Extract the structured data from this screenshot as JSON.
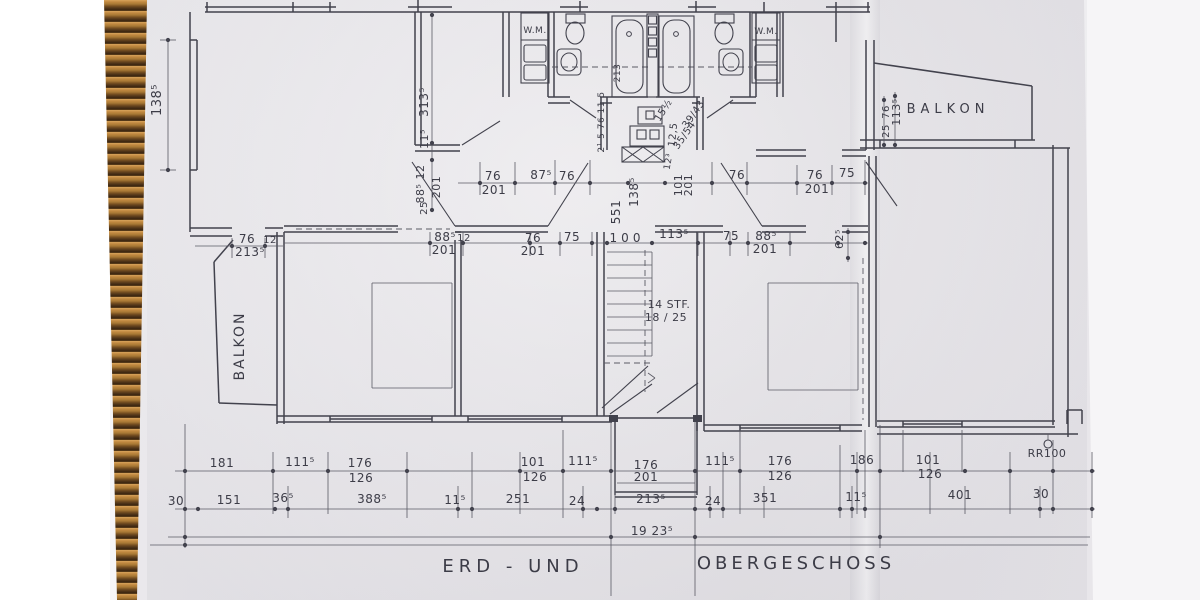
{
  "titles": {
    "left": "ERD - UND",
    "right": "OBERGESCHOSS"
  },
  "colors": {
    "paper": "#e7e5e9",
    "ink": "#42424d",
    "thin_line": "#5a5a64",
    "wicker_light": "#d8a45c",
    "wicker_dark": "#53371a",
    "background": "#ffffff"
  },
  "plan": {
    "labels": [
      {
        "t": "138⁵",
        "x": 161,
        "y": 100,
        "r": -90,
        "s": 13
      },
      {
        "t": "BALKON",
        "x": 244,
        "y": 346,
        "r": -90,
        "s": 14,
        "ls": 2,
        "n": "room-label-balkon-left"
      },
      {
        "t": "76",
        "x": 247,
        "y": 243,
        "s": 12
      },
      {
        "t": "213⁵",
        "x": 250,
        "y": 256,
        "s": 12
      },
      {
        "t": "12",
        "x": 270,
        "y": 243,
        "s": 10
      },
      {
        "t": "313⁵",
        "x": 428,
        "y": 102,
        "r": -90,
        "s": 12
      },
      {
        "t": "11⁵",
        "x": 428,
        "y": 139,
        "r": -90,
        "s": 11
      },
      {
        "t": "88⁵ 12",
        "x": 424,
        "y": 184,
        "r": -90,
        "s": 11
      },
      {
        "t": "201",
        "x": 440,
        "y": 187,
        "r": -90,
        "s": 11
      },
      {
        "t": "25",
        "x": 427,
        "y": 208,
        "r": -90,
        "s": 10
      },
      {
        "t": "W.M.",
        "x": 535,
        "y": 33,
        "s": 9,
        "n": "room-label-wm-left"
      },
      {
        "t": "W.M.",
        "x": 766,
        "y": 34,
        "s": 9,
        "n": "room-label-wm-right"
      },
      {
        "t": "213",
        "x": 620,
        "y": 73,
        "r": -90,
        "s": 9
      },
      {
        "t": "2¹ 5 76 11 5",
        "x": 604,
        "y": 122,
        "r": -90,
        "s": 9
      },
      {
        "t": "15½",
        "x": 666,
        "y": 112,
        "r": -58,
        "s": 10
      },
      {
        "t": "12,5",
        "x": 676,
        "y": 135,
        "r": -84,
        "s": 10
      },
      {
        "t": "35/54",
        "x": 687,
        "y": 137,
        "r": -55,
        "s": 10
      },
      {
        "t": "39/43",
        "x": 696,
        "y": 116,
        "r": -55,
        "s": 10
      },
      {
        "t": "12³",
        "x": 671,
        "y": 162,
        "r": -80,
        "s": 9
      },
      {
        "t": "551",
        "x": 620,
        "y": 212,
        "r": -90,
        "s": 12
      },
      {
        "t": "138⁵",
        "x": 638,
        "y": 192,
        "r": -90,
        "s": 12
      },
      {
        "t": "101",
        "x": 682,
        "y": 185,
        "r": -90,
        "s": 11
      },
      {
        "t": "201",
        "x": 692,
        "y": 185,
        "r": -90,
        "s": 11
      },
      {
        "t": "76",
        "x": 493,
        "y": 180,
        "s": 12
      },
      {
        "t": "201",
        "x": 494,
        "y": 194,
        "s": 12
      },
      {
        "t": "87⁵",
        "x": 541,
        "y": 179,
        "s": 12
      },
      {
        "t": "76",
        "x": 567,
        "y": 180,
        "s": 12
      },
      {
        "t": "76",
        "x": 737,
        "y": 179,
        "s": 12
      },
      {
        "t": "76",
        "x": 815,
        "y": 179,
        "s": 12
      },
      {
        "t": "201",
        "x": 817,
        "y": 193,
        "s": 12
      },
      {
        "t": "75",
        "x": 847,
        "y": 177,
        "s": 12
      },
      {
        "t": "88⁵",
        "x": 445,
        "y": 241,
        "s": 12
      },
      {
        "t": "12",
        "x": 464,
        "y": 241,
        "s": 10
      },
      {
        "t": "201",
        "x": 444,
        "y": 254,
        "s": 12
      },
      {
        "t": "76",
        "x": 533,
        "y": 242,
        "s": 12
      },
      {
        "t": "201",
        "x": 533,
        "y": 255,
        "s": 12
      },
      {
        "t": "75",
        "x": 572,
        "y": 241,
        "s": 12
      },
      {
        "t": "100",
        "x": 627,
        "y": 242,
        "s": 12,
        "ls": 4
      },
      {
        "t": "113⁵",
        "x": 674,
        "y": 238,
        "s": 12
      },
      {
        "t": "75",
        "x": 731,
        "y": 240,
        "s": 12
      },
      {
        "t": "88⁵",
        "x": 766,
        "y": 240,
        "s": 12
      },
      {
        "t": "201",
        "x": 765,
        "y": 253,
        "s": 12
      },
      {
        "t": "62⁵",
        "x": 843,
        "y": 239,
        "r": -90,
        "s": 11
      },
      {
        "t": "76",
        "x": 889,
        "y": 112,
        "r": -90,
        "s": 10
      },
      {
        "t": "25",
        "x": 889,
        "y": 131,
        "r": -90,
        "s": 10
      },
      {
        "t": "113⁵",
        "x": 900,
        "y": 112,
        "r": -90,
        "s": 11
      },
      {
        "t": "BALKON",
        "x": 948,
        "y": 113,
        "s": 13,
        "ls": 5,
        "n": "room-label-balkon-right"
      },
      {
        "t": "14 STF.",
        "x": 669,
        "y": 308,
        "s": 11,
        "n": "stair-note"
      },
      {
        "t": "18 / 25",
        "x": 666,
        "y": 321,
        "s": 11,
        "n": "stair-note"
      },
      {
        "t": "181",
        "x": 222,
        "y": 467,
        "s": 12
      },
      {
        "t": "111⁵",
        "x": 300,
        "y": 466,
        "s": 12
      },
      {
        "t": "176",
        "x": 360,
        "y": 467,
        "s": 12
      },
      {
        "t": "126",
        "x": 361,
        "y": 482,
        "s": 12
      },
      {
        "t": "101",
        "x": 533,
        "y": 466,
        "s": 12
      },
      {
        "t": "126",
        "x": 535,
        "y": 481,
        "s": 12
      },
      {
        "t": "111⁵",
        "x": 583,
        "y": 465,
        "s": 12
      },
      {
        "t": "176",
        "x": 646,
        "y": 469,
        "s": 12
      },
      {
        "t": "201",
        "x": 646,
        "y": 481,
        "s": 12
      },
      {
        "t": "111⁵",
        "x": 720,
        "y": 465,
        "s": 12
      },
      {
        "t": "176",
        "x": 780,
        "y": 465,
        "s": 12
      },
      {
        "t": "126",
        "x": 780,
        "y": 480,
        "s": 12
      },
      {
        "t": "186",
        "x": 862,
        "y": 464,
        "s": 12
      },
      {
        "t": "101",
        "x": 928,
        "y": 464,
        "s": 12
      },
      {
        "t": "126",
        "x": 930,
        "y": 478,
        "s": 12
      },
      {
        "t": "RR100",
        "x": 1047,
        "y": 457,
        "s": 11,
        "n": "drain-label"
      },
      {
        "t": "30",
        "x": 176,
        "y": 505,
        "s": 12
      },
      {
        "t": "151",
        "x": 229,
        "y": 504,
        "s": 12
      },
      {
        "t": "36⁵",
        "x": 283,
        "y": 502,
        "s": 12
      },
      {
        "t": "388⁵",
        "x": 372,
        "y": 503,
        "s": 12
      },
      {
        "t": "11⁵",
        "x": 455,
        "y": 504,
        "s": 12
      },
      {
        "t": "251",
        "x": 518,
        "y": 503,
        "s": 12
      },
      {
        "t": "24",
        "x": 577,
        "y": 505,
        "s": 12
      },
      {
        "t": "213⁵",
        "x": 651,
        "y": 503,
        "s": 12
      },
      {
        "t": "24",
        "x": 713,
        "y": 505,
        "s": 12
      },
      {
        "t": "351",
        "x": 765,
        "y": 502,
        "s": 12
      },
      {
        "t": "11⁵",
        "x": 856,
        "y": 501,
        "s": 12
      },
      {
        "t": "401",
        "x": 960,
        "y": 499,
        "s": 12
      },
      {
        "t": "30",
        "x": 1041,
        "y": 498,
        "s": 12
      },
      {
        "t": "19 23⁵",
        "x": 652,
        "y": 535,
        "s": 12
      },
      {
        "t": "ERD - UND",
        "x": 513,
        "y": 572,
        "s": 18,
        "ls": 5,
        "n": "plan-title-left"
      },
      {
        "t": "OBERGESCHOSS",
        "x": 796,
        "y": 569,
        "s": 18,
        "ls": 4,
        "n": "plan-title-right"
      }
    ]
  }
}
